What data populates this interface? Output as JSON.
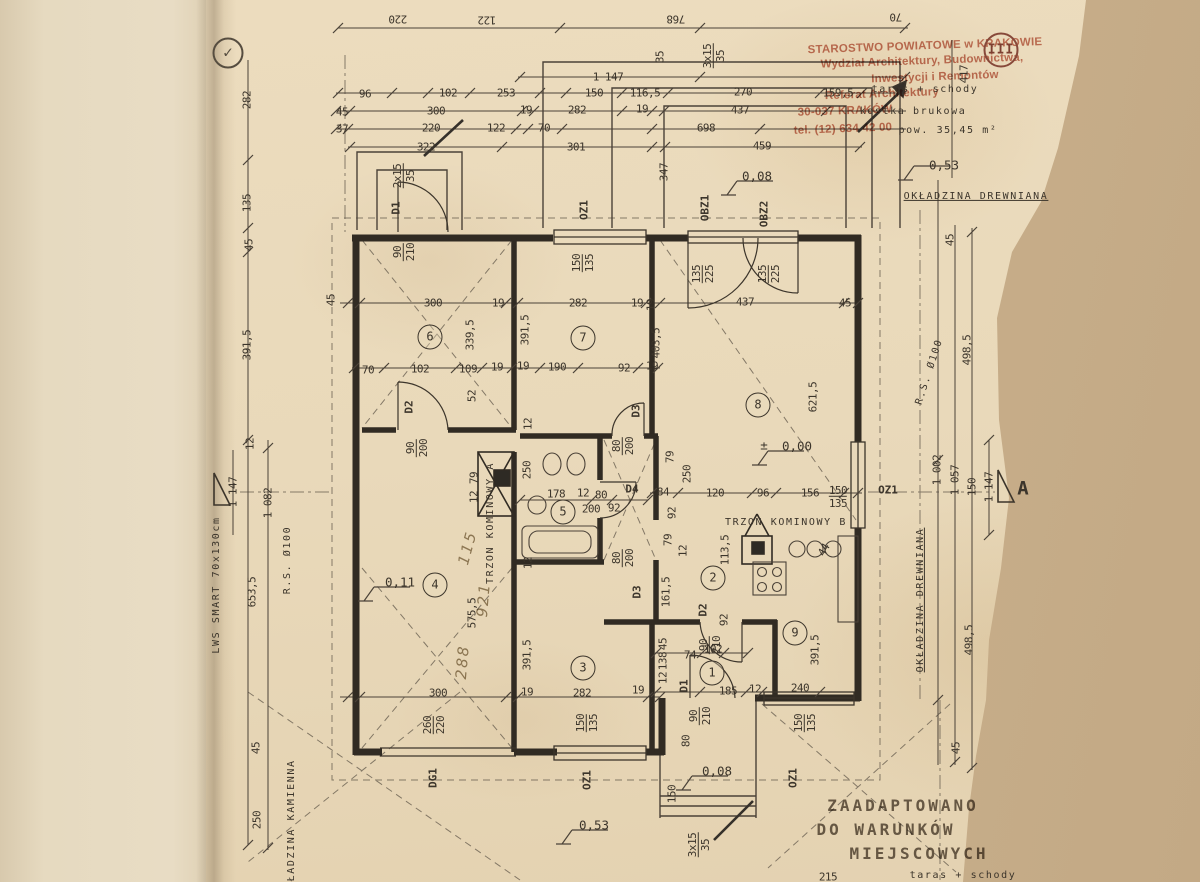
{
  "colors": {
    "paper": "#e9d9ba",
    "background": "#c9b08c",
    "ink": "#3c352b",
    "wall": "#312b23",
    "stamp_red": "#b95640",
    "pencil": "#8f7f63"
  },
  "office_stamp": {
    "lines": [
      "STAROSTWO POWIATOWE w KRAKOWIE",
      "Wydział Architektury, Budownictwa,",
      "Inwestycji i Remontów",
      "Referat Architektury",
      "30-037 KRAKÓW",
      "tel. (12) 634 42 00"
    ]
  },
  "adaptation_stamp": {
    "lines": [
      "ZAADAPTOWANO",
      "DO WARUNKÓW",
      "MIEJSCOWYCH"
    ]
  },
  "page_seal": "III",
  "annotations": [
    {
      "t": "STAROSTWO POWIATOWE w KRAKOWIE",
      "x": 925,
      "y": 47,
      "r": -2,
      "c": "red"
    },
    {
      "t": "Wydział Architektury, Budownictwa,",
      "x": 922,
      "y": 62,
      "r": -2,
      "c": "red"
    },
    {
      "t": "Inwestycji i Remontów",
      "x": 935,
      "y": 78,
      "r": -2,
      "c": "red"
    },
    {
      "t": "Referat Architektury",
      "x": 882,
      "y": 95,
      "r": -2,
      "c": "red"
    },
    {
      "t": "30-037 KRAKÓW",
      "x": 845,
      "y": 112,
      "r": -2,
      "c": "red"
    },
    {
      "t": "tel. (12) 634 42 00",
      "x": 843,
      "y": 130,
      "r": -2,
      "c": "red"
    },
    {
      "t": "III",
      "x": 1001,
      "y": 50,
      "c": "seal"
    },
    {
      "t": "✓",
      "x": 228,
      "y": 53,
      "c": "check"
    },
    {
      "t": "220",
      "x": 398,
      "y": 19,
      "r": 180,
      "c": "dim"
    },
    {
      "t": "122",
      "x": 487,
      "y": 20,
      "r": 180,
      "c": "dim"
    },
    {
      "t": "768",
      "x": 676,
      "y": 19,
      "r": 180,
      "c": "dim"
    },
    {
      "t": "70",
      "x": 896,
      "y": 17,
      "r": 180,
      "c": "dim"
    },
    {
      "t": "1 147",
      "x": 608,
      "y": 77,
      "c": "dim"
    },
    {
      "t": "96",
      "x": 365,
      "y": 94,
      "c": "dim"
    },
    {
      "t": "102",
      "x": 448,
      "y": 93,
      "c": "dim"
    },
    {
      "t": "253",
      "x": 506,
      "y": 93,
      "c": "dim"
    },
    {
      "t": "150",
      "x": 594,
      "y": 93,
      "c": "dim"
    },
    {
      "t": "116,5",
      "x": 645,
      "y": 93,
      "c": "dim"
    },
    {
      "t": "270",
      "x": 743,
      "y": 92,
      "c": "dim"
    },
    {
      "t": "159,5",
      "x": 838,
      "y": 93,
      "c": "dim"
    },
    {
      "t": "taras + schody",
      "x": 925,
      "y": 90,
      "c": "txt"
    },
    {
      "t": "45",
      "x": 342,
      "y": 112,
      "c": "dim"
    },
    {
      "t": "300",
      "x": 436,
      "y": 111,
      "c": "dim"
    },
    {
      "t": "19",
      "x": 526,
      "y": 110,
      "c": "dim"
    },
    {
      "t": "282",
      "x": 577,
      "y": 110,
      "c": "dim"
    },
    {
      "t": "19",
      "x": 642,
      "y": 109,
      "c": "dim"
    },
    {
      "t": "437",
      "x": 740,
      "y": 110,
      "c": "dim"
    },
    {
      "t": "kostka brukowa",
      "x": 913,
      "y": 112,
      "c": "txt"
    },
    {
      "t": "37",
      "x": 342,
      "y": 129,
      "c": "dim"
    },
    {
      "t": "220",
      "x": 431,
      "y": 128,
      "c": "dim"
    },
    {
      "t": "122",
      "x": 496,
      "y": 128,
      "c": "dim"
    },
    {
      "t": "70",
      "x": 544,
      "y": 128,
      "c": "dim"
    },
    {
      "t": "698",
      "x": 706,
      "y": 128,
      "c": "dim"
    },
    {
      "t": "pow. 35,45 m²",
      "x": 948,
      "y": 131,
      "c": "txt"
    },
    {
      "t": "322",
      "x": 426,
      "y": 147,
      "c": "dim"
    },
    {
      "t": "301",
      "x": 576,
      "y": 147,
      "c": "dim"
    },
    {
      "t": "459",
      "x": 762,
      "y": 146,
      "c": "dim"
    },
    {
      "t": "35",
      "x": 660,
      "y": 57,
      "r": -90,
      "c": "dim"
    },
    {
      "t": "3x15/35",
      "x": 714,
      "y": 56,
      "r": -90,
      "f": 1,
      "c": "dim"
    },
    {
      "t": "417",
      "x": 964,
      "y": 74,
      "r": -90,
      "c": "dim"
    },
    {
      "t": "0,53",
      "x": 944,
      "y": 166,
      "c": "level"
    },
    {
      "t": "0,08",
      "x": 757,
      "y": 177,
      "c": "level"
    },
    {
      "t": "347",
      "x": 664,
      "y": 172,
      "r": -90,
      "c": "dim"
    },
    {
      "t": "OKŁADZINA DREWNIANA",
      "x": 976,
      "y": 197,
      "u": 1,
      "c": "txt"
    },
    {
      "t": "2x15/35",
      "x": 404,
      "y": 176,
      "r": -90,
      "f": 1,
      "c": "dim"
    },
    {
      "t": "D1",
      "x": 396,
      "y": 208,
      "r": -90,
      "c": "label"
    },
    {
      "t": "90/210",
      "x": 404,
      "y": 252,
      "r": -90,
      "f": 1,
      "c": "dim"
    },
    {
      "t": "OZ1",
      "x": 584,
      "y": 210,
      "r": -90,
      "c": "label"
    },
    {
      "t": "150/135",
      "x": 583,
      "y": 263,
      "r": -90,
      "f": 1,
      "c": "dim"
    },
    {
      "t": "OBZ1",
      "x": 705,
      "y": 208,
      "r": -90,
      "c": "label"
    },
    {
      "t": "OBZ2",
      "x": 764,
      "y": 214,
      "r": -90,
      "c": "label"
    },
    {
      "t": "135/225",
      "x": 703,
      "y": 274,
      "r": -90,
      "f": 1,
      "c": "dim"
    },
    {
      "t": "135/225",
      "x": 769,
      "y": 274,
      "r": -90,
      "f": 1,
      "c": "dim"
    },
    {
      "t": "282",
      "x": 247,
      "y": 100,
      "r": -90,
      "c": "dim"
    },
    {
      "t": "135",
      "x": 247,
      "y": 203,
      "r": -90,
      "c": "dim"
    },
    {
      "t": "45",
      "x": 249,
      "y": 245,
      "r": -90,
      "c": "dim"
    },
    {
      "t": "391,5",
      "x": 247,
      "y": 345,
      "r": -90,
      "c": "dim"
    },
    {
      "t": "45",
      "x": 331,
      "y": 300,
      "r": -90,
      "c": "dim"
    },
    {
      "t": "300",
      "x": 433,
      "y": 303,
      "c": "dim"
    },
    {
      "t": "19",
      "x": 498,
      "y": 303,
      "c": "dim"
    },
    {
      "t": "282",
      "x": 578,
      "y": 303,
      "c": "dim"
    },
    {
      "t": "19",
      "x": 637,
      "y": 303,
      "c": "dim"
    },
    {
      "t": "437",
      "x": 745,
      "y": 302,
      "c": "dim"
    },
    {
      "t": "45",
      "x": 845,
      "y": 303,
      "c": "dim"
    },
    {
      "t": "45",
      "x": 950,
      "y": 240,
      "r": -90,
      "c": "dim"
    },
    {
      "t": "6",
      "x": 430,
      "y": 337,
      "c": "room"
    },
    {
      "t": "339,5",
      "x": 470,
      "y": 335,
      "r": -90,
      "c": "dim"
    },
    {
      "t": "391,5",
      "x": 525,
      "y": 330,
      "r": -90,
      "c": "dim"
    },
    {
      "t": "7",
      "x": 583,
      "y": 338,
      "c": "room"
    },
    {
      "t": "19",
      "x": 651,
      "y": 305,
      "r": -90,
      "c": "dim"
    },
    {
      "t": "403,5",
      "x": 656,
      "y": 343,
      "r": -90,
      "c": "dim"
    },
    {
      "t": "8",
      "x": 758,
      "y": 405,
      "c": "room"
    },
    {
      "t": "621,5",
      "x": 813,
      "y": 397,
      "r": -90,
      "c": "dim"
    },
    {
      "t": "R.S. Ø100",
      "x": 930,
      "y": 372,
      "r": -72,
      "c": "txt"
    },
    {
      "t": "498,5",
      "x": 967,
      "y": 350,
      "r": -90,
      "c": "dim"
    },
    {
      "t": "70",
      "x": 368,
      "y": 370,
      "c": "dim"
    },
    {
      "t": "102",
      "x": 420,
      "y": 369,
      "c": "dim"
    },
    {
      "t": "109",
      "x": 468,
      "y": 369,
      "c": "dim"
    },
    {
      "t": "19",
      "x": 497,
      "y": 367,
      "c": "dim"
    },
    {
      "t": "19",
      "x": 523,
      "y": 366,
      "c": "dim"
    },
    {
      "t": "190",
      "x": 557,
      "y": 367,
      "c": "dim"
    },
    {
      "t": "92",
      "x": 624,
      "y": 368,
      "c": "dim"
    },
    {
      "t": "19",
      "x": 652,
      "y": 366,
      "c": "dim"
    },
    {
      "t": "52",
      "x": 472,
      "y": 396,
      "r": -90,
      "c": "dim"
    },
    {
      "t": "D2",
      "x": 409,
      "y": 407,
      "r": -90,
      "c": "label"
    },
    {
      "t": "90/200",
      "x": 417,
      "y": 448,
      "r": -90,
      "f": 1,
      "c": "dim"
    },
    {
      "t": "D3",
      "x": 636,
      "y": 411,
      "r": -90,
      "c": "label"
    },
    {
      "t": "80/200",
      "x": 623,
      "y": 446,
      "r": -90,
      "f": 1,
      "c": "dim"
    },
    {
      "t": "12",
      "x": 528,
      "y": 424,
      "r": -90,
      "c": "dim"
    },
    {
      "t": "±",
      "x": 764,
      "y": 446,
      "c": "level"
    },
    {
      "t": "0,00",
      "x": 797,
      "y": 447,
      "c": "level"
    },
    {
      "t": "79",
      "x": 670,
      "y": 457,
      "r": -90,
      "c": "dim"
    },
    {
      "t": "250",
      "x": 687,
      "y": 474,
      "r": -90,
      "c": "dim"
    },
    {
      "t": "92",
      "x": 672,
      "y": 513,
      "r": -90,
      "c": "dim"
    },
    {
      "t": "79",
      "x": 668,
      "y": 540,
      "r": -90,
      "c": "dim"
    },
    {
      "t": "12",
      "x": 683,
      "y": 551,
      "r": -90,
      "c": "dim"
    },
    {
      "t": "TRZON KOMINOWY A",
      "x": 491,
      "y": 523,
      "r": -90,
      "c": "txt"
    },
    {
      "t": "79",
      "x": 474,
      "y": 478,
      "r": -90,
      "c": "dim"
    },
    {
      "t": "12",
      "x": 474,
      "y": 497,
      "r": -90,
      "c": "dim"
    },
    {
      "t": "250",
      "x": 527,
      "y": 470,
      "r": -90,
      "c": "dim"
    },
    {
      "t": "178",
      "x": 556,
      "y": 494,
      "c": "dim"
    },
    {
      "t": "12",
      "x": 583,
      "y": 493,
      "c": "dim"
    },
    {
      "t": "80",
      "x": 601,
      "y": 495,
      "c": "dim"
    },
    {
      "t": "200",
      "x": 591,
      "y": 509,
      "c": "dim"
    },
    {
      "t": "92",
      "x": 614,
      "y": 508,
      "c": "dim"
    },
    {
      "t": "5",
      "x": 563,
      "y": 512,
      "c": "room"
    },
    {
      "t": "D4",
      "x": 632,
      "y": 489,
      "c": "label"
    },
    {
      "t": "84",
      "x": 663,
      "y": 492,
      "c": "dim"
    },
    {
      "t": "120",
      "x": 715,
      "y": 493,
      "c": "dim"
    },
    {
      "t": "96",
      "x": 763,
      "y": 493,
      "c": "dim"
    },
    {
      "t": "156",
      "x": 810,
      "y": 493,
      "c": "dim"
    },
    {
      "t": "150/135",
      "x": 838,
      "y": 497,
      "f": 1,
      "c": "dim"
    },
    {
      "t": "OZ1",
      "x": 888,
      "y": 490,
      "c": "label"
    },
    {
      "t": "1 002",
      "x": 937,
      "y": 470,
      "r": -90,
      "c": "dim"
    },
    {
      "t": "1 057",
      "x": 955,
      "y": 480,
      "r": -90,
      "c": "dim"
    },
    {
      "t": "150",
      "x": 972,
      "y": 487,
      "r": -90,
      "c": "dim"
    },
    {
      "t": "1 147",
      "x": 989,
      "y": 487,
      "r": -90,
      "c": "dim"
    },
    {
      "t": "A",
      "x": 1023,
      "y": 489,
      "c": "label",
      "s": 19
    },
    {
      "t": "TRZON KOMINOWY B",
      "x": 786,
      "y": 523,
      "c": "txt"
    },
    {
      "t": "113,5",
      "x": 725,
      "y": 550,
      "r": -90,
      "c": "dim"
    },
    {
      "t": "44",
      "x": 824,
      "y": 550,
      "r": -60,
      "c": "dim"
    },
    {
      "t": "2",
      "x": 713,
      "y": 578,
      "c": "room"
    },
    {
      "t": "161,5",
      "x": 666,
      "y": 592,
      "r": -90,
      "c": "dim"
    },
    {
      "t": "D2",
      "x": 703,
      "y": 610,
      "r": -90,
      "c": "label"
    },
    {
      "t": "90/210",
      "x": 710,
      "y": 645,
      "r": -90,
      "f": 1,
      "c": "dim"
    },
    {
      "t": "92",
      "x": 724,
      "y": 620,
      "r": -90,
      "c": "dim"
    },
    {
      "t": "9",
      "x": 795,
      "y": 633,
      "c": "room"
    },
    {
      "t": "391,5",
      "x": 815,
      "y": 650,
      "r": -90,
      "c": "dim"
    },
    {
      "t": "OKŁADZINA DREWNIANA",
      "x": 921,
      "y": 600,
      "r": -90,
      "u": 1,
      "c": "txt"
    },
    {
      "t": "498,5",
      "x": 969,
      "y": 640,
      "r": -90,
      "c": "dim"
    },
    {
      "t": "0,11",
      "x": 400,
      "y": 583,
      "c": "level"
    },
    {
      "t": "4",
      "x": 435,
      "y": 585,
      "c": "room"
    },
    {
      "t": "575,5",
      "x": 472,
      "y": 613,
      "r": -90,
      "c": "dim"
    },
    {
      "t": "115",
      "x": 468,
      "y": 548,
      "r": -75,
      "c": "hand"
    },
    {
      "t": "921",
      "x": 484,
      "y": 600,
      "r": -85,
      "c": "hand"
    },
    {
      "t": "288",
      "x": 463,
      "y": 662,
      "r": -85,
      "c": "hand"
    },
    {
      "t": "12",
      "x": 528,
      "y": 563,
      "r": -90,
      "c": "dim"
    },
    {
      "t": "80/200",
      "x": 623,
      "y": 558,
      "r": -90,
      "f": 1,
      "c": "dim"
    },
    {
      "t": "D3",
      "x": 637,
      "y": 592,
      "r": -90,
      "c": "label"
    },
    {
      "t": "391,5",
      "x": 527,
      "y": 655,
      "r": -90,
      "c": "dim"
    },
    {
      "t": "3",
      "x": 583,
      "y": 668,
      "c": "room"
    },
    {
      "t": "74",
      "x": 690,
      "y": 655,
      "c": "dim"
    },
    {
      "t": "102",
      "x": 713,
      "y": 649,
      "c": "dim"
    },
    {
      "t": "1",
      "x": 712,
      "y": 673,
      "c": "room"
    },
    {
      "t": "45",
      "x": 663,
      "y": 644,
      "r": -90,
      "c": "dim"
    },
    {
      "t": "138",
      "x": 663,
      "y": 661,
      "r": -90,
      "c": "dim"
    },
    {
      "t": "12",
      "x": 663,
      "y": 678,
      "r": -90,
      "c": "dim"
    },
    {
      "t": "D1",
      "x": 684,
      "y": 686,
      "r": -90,
      "c": "label"
    },
    {
      "t": "185",
      "x": 728,
      "y": 691,
      "c": "dim"
    },
    {
      "t": "12",
      "x": 755,
      "y": 689,
      "c": "dim"
    },
    {
      "t": "240",
      "x": 800,
      "y": 688,
      "c": "dim"
    },
    {
      "t": "300",
      "x": 438,
      "y": 693,
      "c": "dim"
    },
    {
      "t": "19",
      "x": 527,
      "y": 692,
      "c": "dim"
    },
    {
      "t": "282",
      "x": 582,
      "y": 693,
      "c": "dim"
    },
    {
      "t": "19",
      "x": 638,
      "y": 690,
      "c": "dim"
    },
    {
      "t": "260/220",
      "x": 434,
      "y": 725,
      "r": -90,
      "f": 1,
      "c": "dim"
    },
    {
      "t": "DG1",
      "x": 433,
      "y": 778,
      "r": -90,
      "c": "label"
    },
    {
      "t": "150/135",
      "x": 587,
      "y": 723,
      "r": -90,
      "f": 1,
      "c": "dim"
    },
    {
      "t": "OZ1",
      "x": 587,
      "y": 780,
      "r": -90,
      "c": "label"
    },
    {
      "t": "90/210",
      "x": 700,
      "y": 716,
      "r": -90,
      "f": 1,
      "c": "dim"
    },
    {
      "t": "80",
      "x": 686,
      "y": 741,
      "r": -90,
      "c": "dim"
    },
    {
      "t": "150",
      "x": 672,
      "y": 794,
      "r": -90,
      "c": "dim"
    },
    {
      "t": "3x15/35",
      "x": 699,
      "y": 845,
      "r": -90,
      "f": 1,
      "c": "dim"
    },
    {
      "t": "0,08",
      "x": 717,
      "y": 772,
      "c": "level"
    },
    {
      "t": "0,53",
      "x": 594,
      "y": 826,
      "c": "level"
    },
    {
      "t": "150/135",
      "x": 805,
      "y": 723,
      "r": -90,
      "f": 1,
      "c": "dim"
    },
    {
      "t": "OZ1",
      "x": 793,
      "y": 778,
      "r": -90,
      "c": "label"
    },
    {
      "t": "45",
      "x": 956,
      "y": 748,
      "r": -90,
      "c": "dim"
    },
    {
      "t": "1 147",
      "x": 233,
      "y": 492,
      "r": -90,
      "c": "dim"
    },
    {
      "t": "12",
      "x": 250,
      "y": 444,
      "r": -90,
      "c": "dim"
    },
    {
      "t": "1 082",
      "x": 268,
      "y": 503,
      "r": -90,
      "c": "dim"
    },
    {
      "t": "653,5",
      "x": 252,
      "y": 592,
      "r": -90,
      "c": "dim"
    },
    {
      "t": "R.S. Ø100",
      "x": 288,
      "y": 560,
      "r": -90,
      "c": "txt"
    },
    {
      "t": "45",
      "x": 256,
      "y": 748,
      "r": -90,
      "c": "dim"
    },
    {
      "t": "250",
      "x": 257,
      "y": 820,
      "r": -90,
      "c": "dim"
    },
    {
      "t": "OKŁADZINA KAMIENNA",
      "x": 292,
      "y": 828,
      "r": -90,
      "c": "txt"
    },
    {
      "t": "LWS SMART 70x130cm",
      "x": 217,
      "y": 585,
      "r": -90,
      "c": "txt"
    },
    {
      "t": "ZAADAPTOWANO",
      "x": 903,
      "y": 806,
      "c": "stamp"
    },
    {
      "t": "DO WARUNKÓW",
      "x": 886,
      "y": 830,
      "c": "stamp"
    },
    {
      "t": "MIEJSCOWYCH",
      "x": 919,
      "y": 854,
      "c": "stamp"
    },
    {
      "t": "215",
      "x": 828,
      "y": 877,
      "c": "dim"
    },
    {
      "t": "taras + schody",
      "x": 963,
      "y": 876,
      "c": "txt"
    }
  ]
}
